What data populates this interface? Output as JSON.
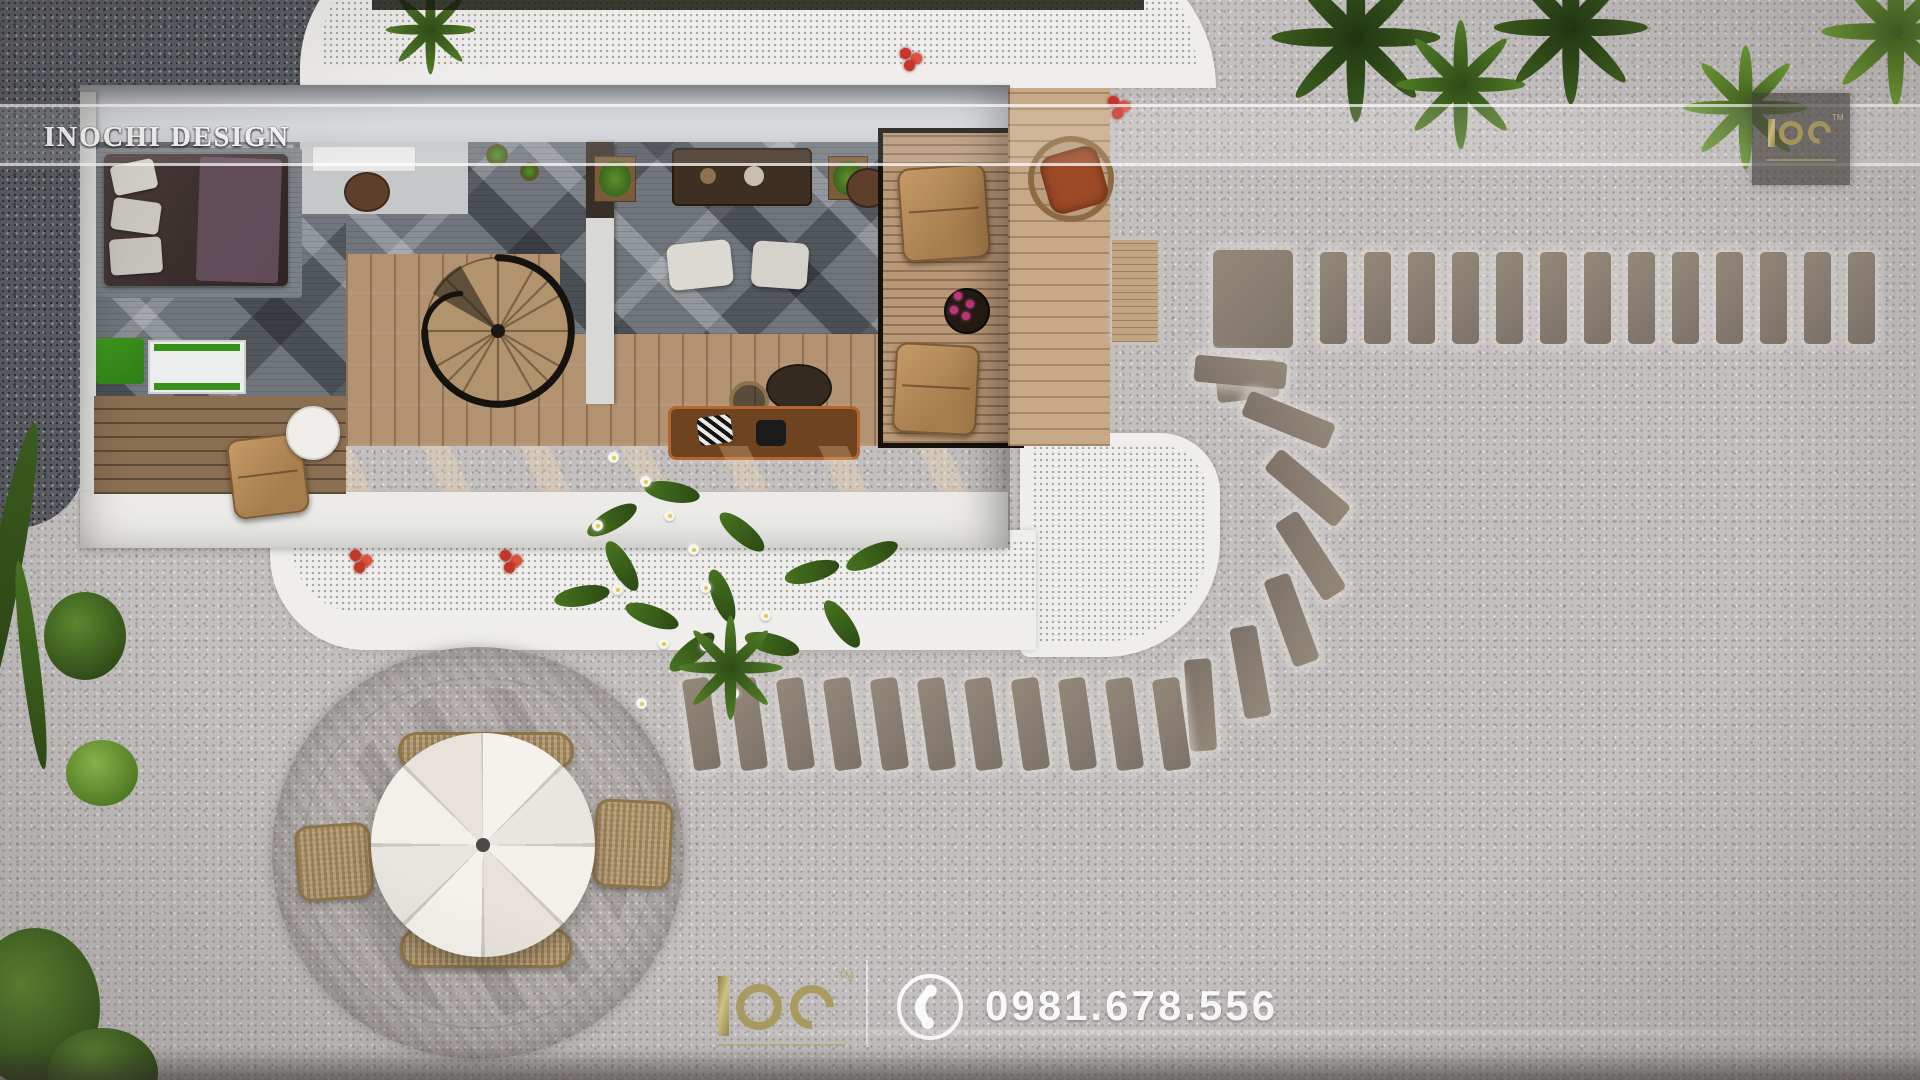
{
  "watermark": {
    "label": "INOCHI DESIGN",
    "separator": "-",
    "repeats": 8
  },
  "brand_badge": {
    "name": "IOC",
    "trademark": "TM",
    "logo_icon": "ioc-gold-monogram-icon"
  },
  "footer": {
    "brand": "IOC",
    "trademark": "TM",
    "phone": "0981.678.556",
    "phone_icon": "phone-handset-icon",
    "separator_icon": "vertical-divider"
  },
  "colors": {
    "gravel_light": "#c3bfbe",
    "gravel_dark": "#585b61",
    "stepping_stone": "#8a7e74",
    "grass_bright": "#6b9c2c",
    "grass_shadow": "#24400f",
    "path_white": "#efeeec",
    "roof": "#e3e6ea",
    "carpet_gray": "#70767c",
    "wood_floor": "#b29271",
    "deck_walkway": "#6f5a45",
    "leather_tan": "#bc9360",
    "rust_cushion": "#9c4a26",
    "umbrella_white": "#f2efe9",
    "gold_logo": "#ab9d60",
    "flower_red": "#c63527",
    "flower_pink": "#c2347e"
  },
  "scene": {
    "description_objects": [
      "villa-top-view",
      "bedroom-bed",
      "spiral-staircase",
      "dining-table",
      "pergola-lounge",
      "wood-decks",
      "round-umbrella-dining-set",
      "stepping-stone-paths",
      "lawn-with-flowers",
      "tropical-plants",
      "gravel-yard"
    ],
    "stones": {
      "top_row": {
        "count": 13,
        "x": 1320,
        "y": 252,
        "pitch": 44
      },
      "bottom_row": {
        "count": 11,
        "x": 688,
        "y": 678,
        "pitch": 47,
        "rotate": -8
      },
      "arc": [
        {
          "x": 1240,
          "y": 372,
          "rot": 95
        },
        {
          "x": 1288,
          "y": 420,
          "rot": 112
        },
        {
          "x": 1307,
          "y": 488,
          "rot": 130
        },
        {
          "x": 1310,
          "y": 556,
          "rot": 147
        },
        {
          "x": 1291,
          "y": 620,
          "rot": 160
        },
        {
          "x": 1250,
          "y": 672,
          "rot": 170
        },
        {
          "x": 1200,
          "y": 705,
          "rot": 176
        }
      ]
    },
    "pink_flower_dots": [
      [
        8,
        2
      ],
      [
        20,
        10
      ],
      [
        4,
        16
      ],
      [
        16,
        22
      ]
    ],
    "plumeria_leaves": [
      [
        612,
        520,
        -30
      ],
      [
        672,
        492,
        10
      ],
      [
        742,
        532,
        40
      ],
      [
        812,
        572,
        -15
      ],
      [
        722,
        596,
        70
      ],
      [
        652,
        616,
        20
      ],
      [
        692,
        652,
        -40
      ],
      [
        772,
        644,
        15
      ],
      [
        842,
        624,
        55
      ],
      [
        872,
        556,
        -25
      ],
      [
        622,
        566,
        60
      ],
      [
        582,
        596,
        -10
      ]
    ],
    "plumeria_flowers": [
      [
        608,
        452
      ],
      [
        640,
        476
      ],
      [
        664,
        510
      ],
      [
        688,
        544
      ],
      [
        612,
        584
      ],
      [
        700,
        582
      ],
      [
        658,
        638
      ],
      [
        728,
        688
      ],
      [
        700,
        640
      ],
      [
        636,
        698
      ],
      [
        760,
        610
      ],
      [
        592,
        520
      ]
    ],
    "red_flowers": [
      [
        900,
        48
      ],
      [
        1108,
        96
      ],
      [
        350,
        550
      ],
      [
        500,
        550
      ]
    ]
  }
}
